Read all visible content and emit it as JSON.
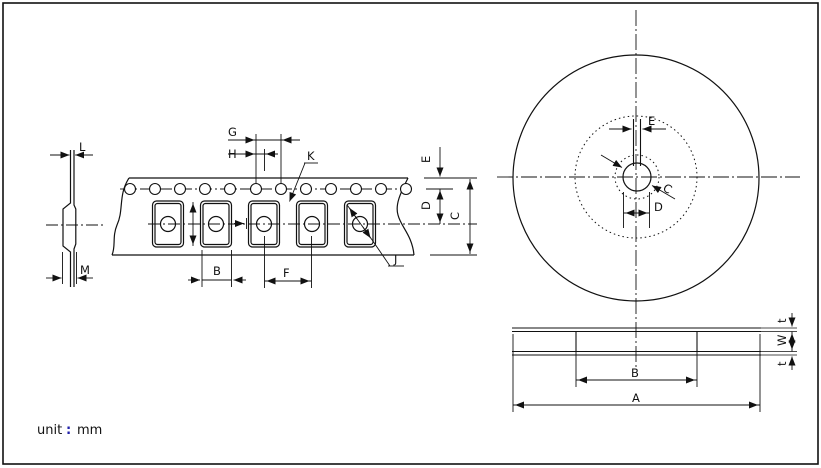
{
  "title": "tape-and-reel-packaging-dimensions-drawing",
  "unit": {
    "prefix": "unit",
    "separator": ":",
    "value": "mm"
  },
  "colors": {
    "line": "#1a1a1a",
    "colon": "#2222aa",
    "background": "#ffffff"
  },
  "labels": {
    "profile": {
      "L": "L",
      "M": "M"
    },
    "tape": {
      "G": "G",
      "H": "H",
      "K": "K",
      "E": "E",
      "D": "D",
      "C": "C",
      "B": "B",
      "F": "F",
      "J": "J"
    },
    "reel_front": {
      "E": "E",
      "C": "C",
      "D": "D"
    },
    "reel_side": {
      "A": "A",
      "B": "B",
      "W": "W",
      "t_top": "t",
      "t_bottom": "t"
    }
  },
  "views": {
    "left": "carrier-tape-top-view-with-edge-profile",
    "right_top": "reel-front-view",
    "right_bottom": "reel-side-view"
  }
}
